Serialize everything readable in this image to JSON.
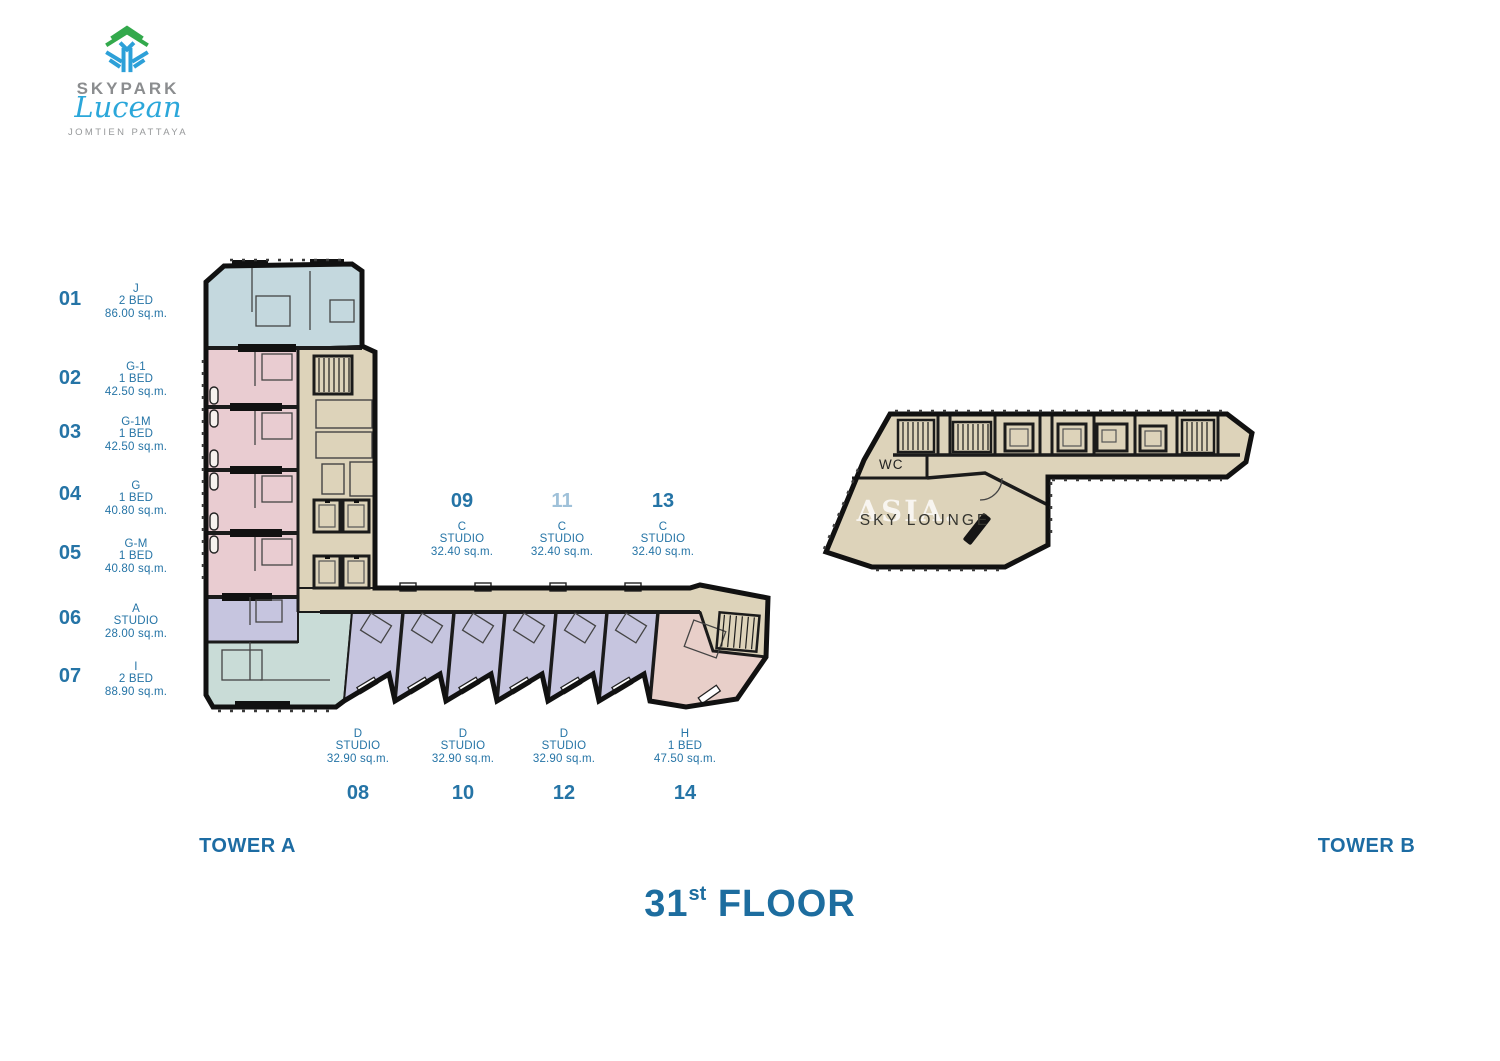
{
  "brand": {
    "name": "SKYPARK",
    "script": "Lucean",
    "location": "JOMTIEN PATTAYA"
  },
  "floor_title": {
    "number": "31",
    "ordinal": "st",
    "word": "FLOOR"
  },
  "towers": {
    "a": "TOWER A",
    "b": "TOWER B"
  },
  "unit_list": [
    {
      "no": "01",
      "type": "J",
      "bed": "2 BED",
      "area": "86.00 sq.m."
    },
    {
      "no": "02",
      "type": "G-1",
      "bed": "1 BED",
      "area": "42.50 sq.m."
    },
    {
      "no": "03",
      "type": "G-1M",
      "bed": "1 BED",
      "area": "42.50 sq.m."
    },
    {
      "no": "04",
      "type": "G",
      "bed": "1 BED",
      "area": "40.80 sq.m."
    },
    {
      "no": "05",
      "type": "G-M",
      "bed": "1 BED",
      "area": "40.80 sq.m."
    },
    {
      "no": "06",
      "type": "A",
      "bed": "STUDIO",
      "area": "28.00 sq.m."
    },
    {
      "no": "07",
      "type": "I",
      "bed": "2 BED",
      "area": "88.90 sq.m."
    }
  ],
  "corridor_labels_top": [
    {
      "no": "09",
      "type": "C",
      "bed": "STUDIO",
      "area": "32.40 sq.m."
    },
    {
      "no": "11",
      "type": "C",
      "bed": "STUDIO",
      "area": "32.40 sq.m."
    },
    {
      "no": "13",
      "type": "C",
      "bed": "STUDIO",
      "area": "32.40 sq.m."
    }
  ],
  "corridor_labels_bottom": [
    {
      "no": "08",
      "type": "D",
      "bed": "STUDIO",
      "area": "32.90 sq.m."
    },
    {
      "no": "10",
      "type": "D",
      "bed": "STUDIO",
      "area": "32.90 sq.m."
    },
    {
      "no": "12",
      "type": "D",
      "bed": "STUDIO",
      "area": "32.90 sq.m."
    },
    {
      "no": "14",
      "type": "H",
      "bed": "1 BED",
      "area": "47.50 sq.m."
    }
  ],
  "plan_labels": {
    "wc": "WC",
    "sky_lounge": "SKY LOUNGE",
    "watermark": "• ASIA."
  },
  "colors": {
    "text_blue": "#2574a6",
    "title_blue": "#1d6d9f",
    "unit_blue": "#c4d8de",
    "unit_pink": "#e9ccd1",
    "unit_lavender": "#c6c5df",
    "unit_teal": "#c9dcd7",
    "unit_salmon": "#e8cfc9",
    "core_beige": "#ddd3ba",
    "wall_black": "#1b1b1b",
    "logo_green": "#33a94c",
    "logo_blue": "#2da0d8"
  }
}
